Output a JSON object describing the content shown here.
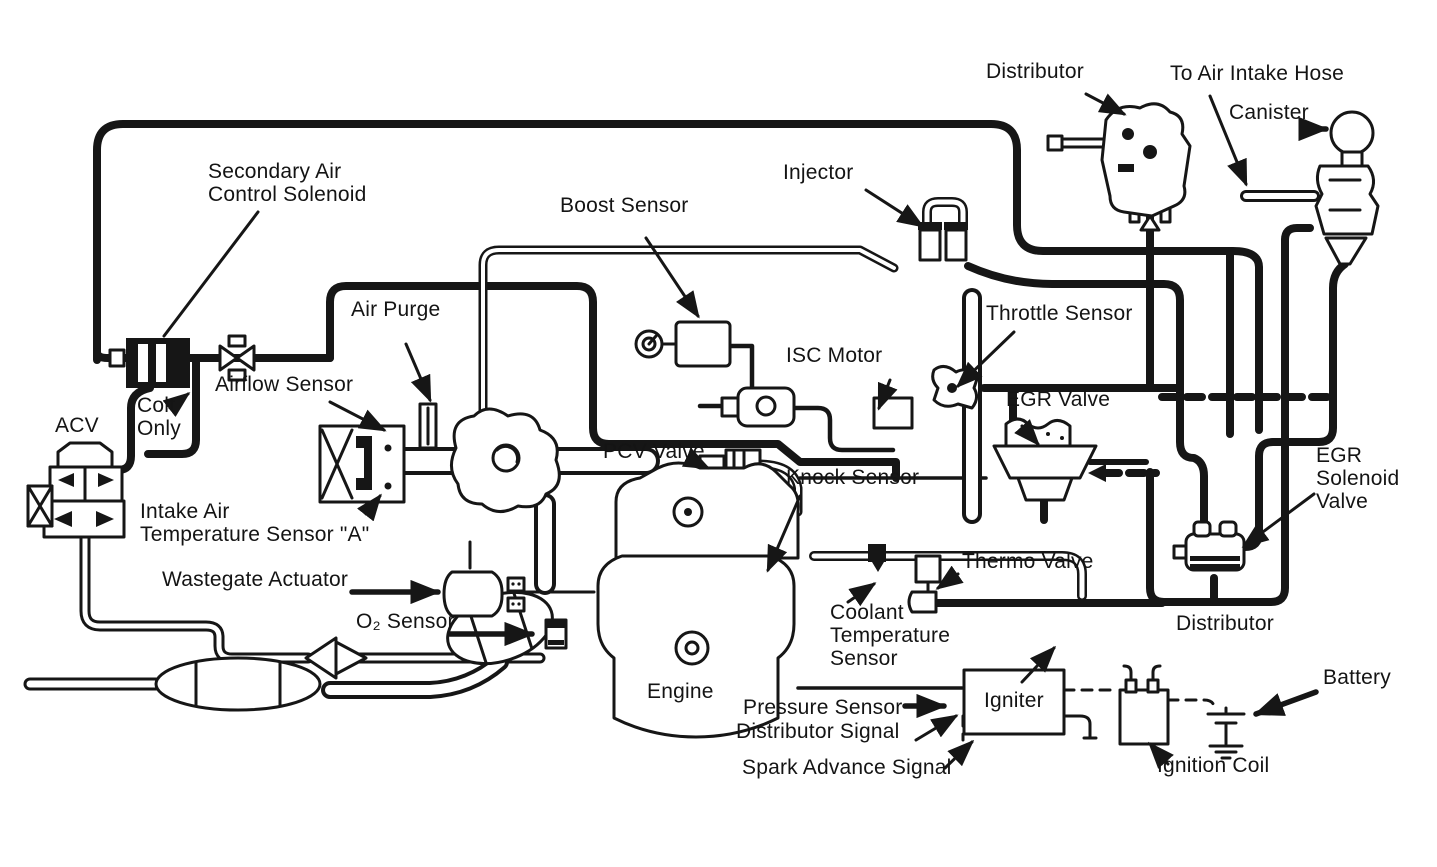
{
  "colors": {
    "ink": "#161616",
    "paper": "#ffffff"
  },
  "labels": {
    "distributor_top": "Distributor",
    "to_air_intake_hose": "To Air Intake Hose",
    "canister": "Canister",
    "secondary_air": "Secondary Air\nControl Solenoid",
    "injector": "Injector",
    "boost_sensor": "Boost Sensor",
    "air_purge": "Air Purge",
    "throttle_sensor": "Throttle Sensor",
    "isc_motor": "ISC Motor",
    "egr_valve": "EGR Valve",
    "colt_only": "Colt\nOnly",
    "airflow_sensor": "Airflow Sensor",
    "acv": "ACV",
    "pcv_valve": "PCV Valve",
    "knock_sensor": "Knock Sensor",
    "egr_solenoid_valve": "EGR\nSolenoid\nValve",
    "intake_air_temp": "Intake Air\nTemperature Sensor \"A\"",
    "wastegate_actuator": "Wastegate Actuator",
    "o2_sensor": "O₂ Sensor",
    "thermo_valve": "Thermo Valve",
    "coolant_temp": "Coolant\nTemperature\nSensor",
    "distributor_bottom": "Distributor",
    "engine": "Engine",
    "pressure_sensor": "Pressure Sensor",
    "igniter": "Igniter",
    "battery": "Battery",
    "distributor_signal": "Distributor Signal",
    "spark_advance_signal": "Spark Advance Signal",
    "ignition_coil": "Ignition Coil"
  }
}
